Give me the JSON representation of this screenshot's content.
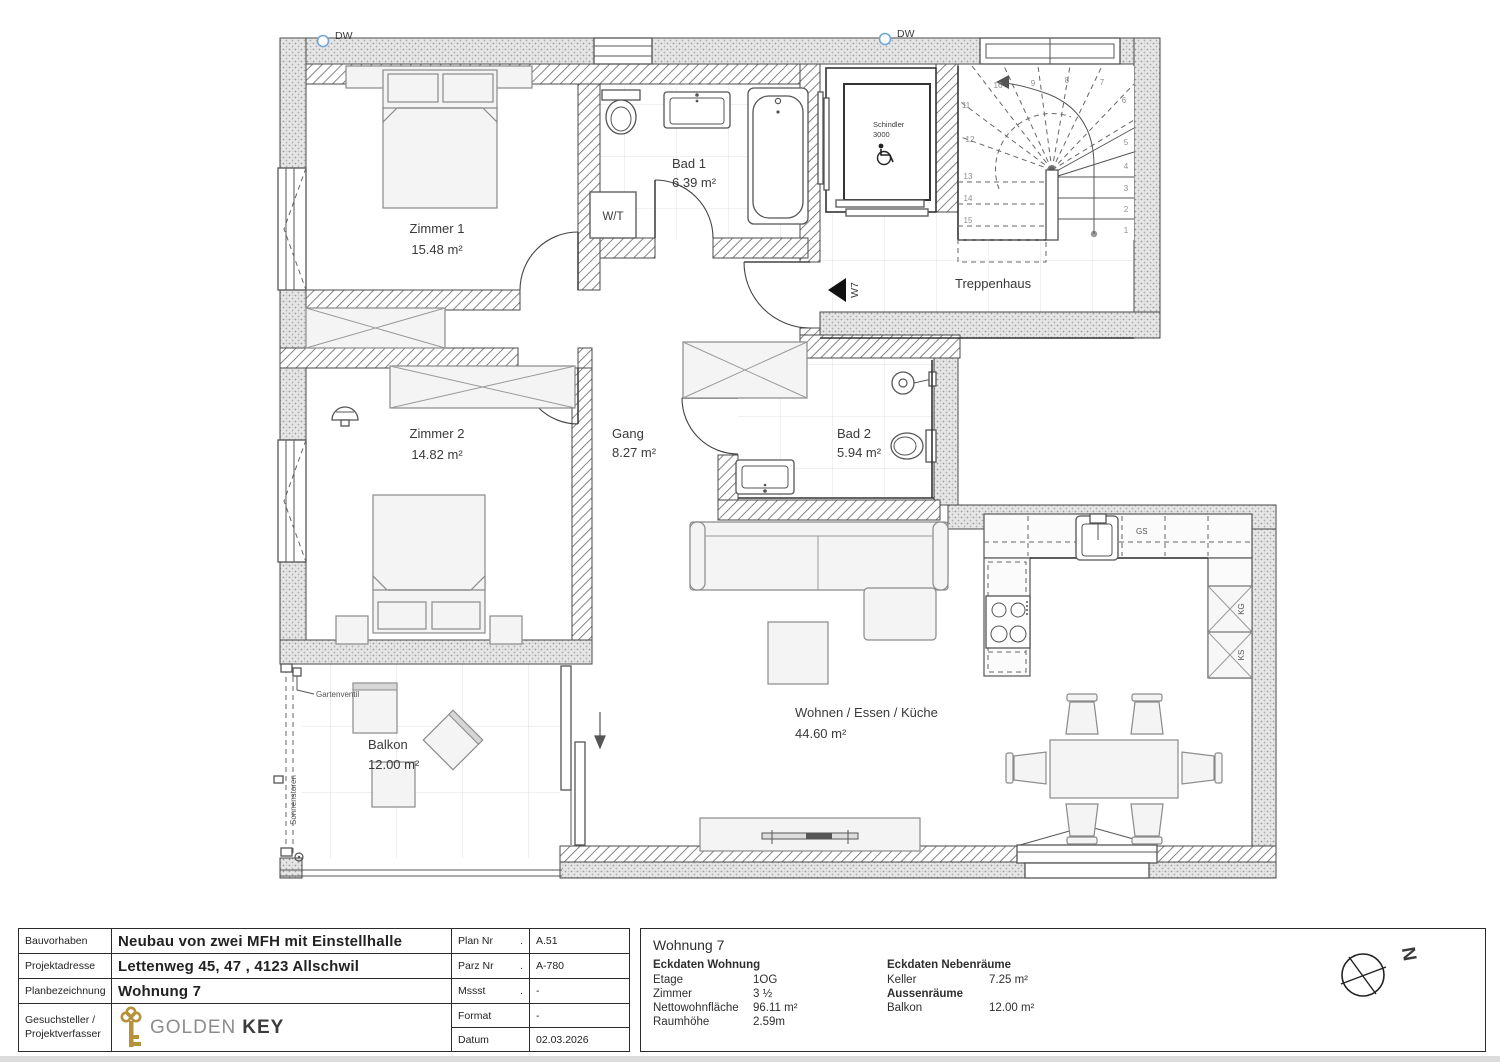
{
  "plan": {
    "dw": "DW",
    "rooms": {
      "zimmer1": {
        "name": "Zimmer 1",
        "area": "15.48 m²"
      },
      "zimmer2": {
        "name": "Zimmer 2",
        "area": "14.82 m²"
      },
      "bad1": {
        "name": "Bad 1",
        "area": "6.39 m²"
      },
      "bad2": {
        "name": "Bad 2",
        "area": "5.94 m²"
      },
      "gang": {
        "name": "Gang",
        "area": "8.27 m²"
      },
      "wohnen": {
        "name": "Wohnen / Essen / Küche",
        "area": "44.60 m²"
      },
      "balkon": {
        "name": "Balkon",
        "area": "12.00 m²"
      },
      "treppenhaus": {
        "name": "Treppenhaus"
      }
    },
    "markers": {
      "w7": "W7",
      "wt": "W/T",
      "elevator_line1": "Schindler",
      "elevator_line2": "3000",
      "gs": "GS",
      "kg": "KG",
      "ks": "KS",
      "gartenventil": "Gartenventil",
      "sonnenstoren": "Sonnenstoren",
      "north": "N"
    },
    "stairs": [
      "1",
      "2",
      "3",
      "4",
      "5",
      "6",
      "7",
      "8",
      "9",
      "10",
      "11",
      "12",
      "13",
      "14",
      "15",
      "16"
    ]
  },
  "titleblock": {
    "rows": [
      {
        "label": "Bauvorhaben",
        "value": "Neubau von zwei MFH mit Einstellhalle"
      },
      {
        "label": "Projektadresse",
        "value": "Lettenweg 45, 47 , 4123 Allschwil"
      },
      {
        "label": "Planbezeichnung",
        "value": "Wohnung 7"
      },
      {
        "label": "Gesuchsteller / Projektverfasser",
        "value": ""
      }
    ],
    "logo": {
      "part1": "GOLDEN",
      "part2": "KEY"
    },
    "meta": [
      {
        "key": "Plan Nr",
        "dot": ".",
        "value": "A.51"
      },
      {
        "key": "Parz Nr",
        "dot": ".",
        "value": "A-780"
      },
      {
        "key": "Mssst",
        "dot": ".",
        "value": "-"
      },
      {
        "key": "Format",
        "dot": "",
        "value": "-"
      },
      {
        "key": "Datum",
        "dot": "",
        "value": "02.03.2026"
      }
    ]
  },
  "panel": {
    "title": "Wohnung 7",
    "left": {
      "header": "Eckdaten Wohnung",
      "rows": [
        {
          "label": "Etage",
          "value": "1OG"
        },
        {
          "label": "Zimmer",
          "value": "3 ½"
        },
        {
          "label": "Nettowohnfläche",
          "value": "96.11 m²"
        },
        {
          "label": "Raumhöhe",
          "value": "2.59m"
        }
      ]
    },
    "right": {
      "header": "Eckdaten Nebenräume",
      "rows": [
        {
          "label": "Keller",
          "value": "7.25 m²"
        },
        {
          "label": "Aussenräume",
          "value": ""
        },
        {
          "label": "Balkon",
          "value": "12.00 m²"
        }
      ]
    }
  }
}
